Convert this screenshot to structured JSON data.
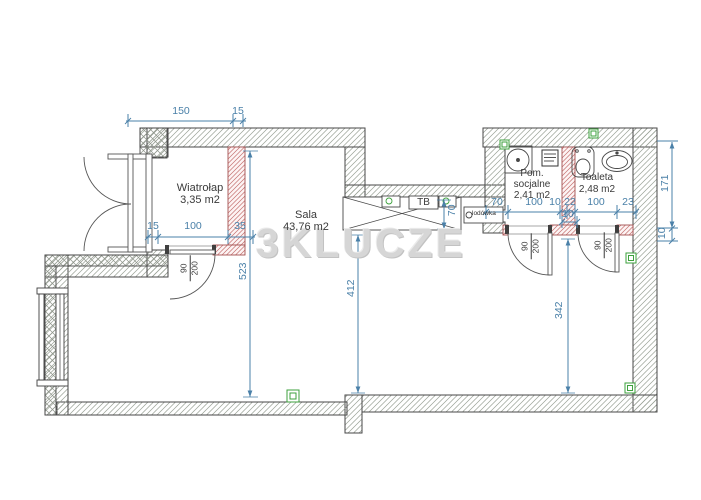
{
  "watermark": "3KLUCZE",
  "rooms": {
    "wiatrolap": {
      "name": "Wiatrołap",
      "area": "3,35 m2"
    },
    "sala": {
      "name": "Sala",
      "area": "43,76 m2"
    },
    "pom_socjalne": {
      "name_line1": "Pom.",
      "name_line2": "socjalne",
      "area": "2,41 m2"
    },
    "toaleta": {
      "name": "Toaleta",
      "area": "2,48 m2"
    }
  },
  "fixtures": {
    "counter_label": "TB",
    "fridge_label": "lodówka"
  },
  "door_size": {
    "width": "90",
    "height": "200"
  },
  "dimensions": {
    "entry_width": "150",
    "entry_wall": "15",
    "wiatrolap_left": "15",
    "wiatrolap_width": "100",
    "wiatrolap_wall": "35",
    "sala_height": "523",
    "sala_inner_height": "412",
    "counter_depth": "70",
    "fridge_width": "70",
    "pom_width": "100",
    "gap_small": "10",
    "partition_22": "22",
    "toaleta_width": "100",
    "toaleta_right": "23",
    "niche_10": "10",
    "right_height": "171",
    "right_wall_10": "10",
    "corridor_height": "342"
  },
  "colors": {
    "dimension_blue": "#4a80a8",
    "partition_red": "#c4706f",
    "outlet_green": "#3da23d",
    "watermark_gray": "#d6d6d6"
  }
}
